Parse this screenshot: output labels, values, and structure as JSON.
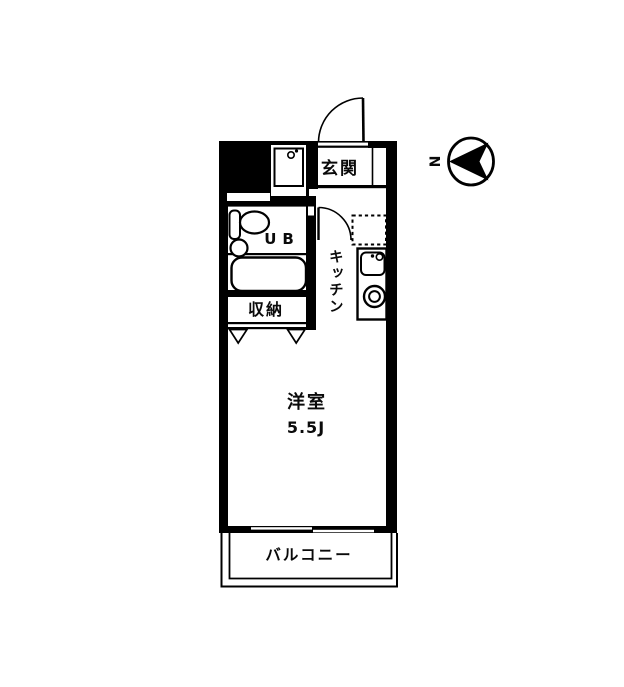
{
  "meta": {
    "type": "apartment-floor-plan",
    "layout": "1R studio"
  },
  "colors": {
    "ink": "#000000",
    "paper": "#ffffff"
  },
  "labels": {
    "entrance": "玄関",
    "unit_bath": "UB",
    "kitchen": "キッチン",
    "storage": "収納",
    "western_room": "洋室",
    "room_size": "5.5J",
    "balcony": "バルコニー",
    "north": "N"
  },
  "compass": {
    "label": "N",
    "arrow_direction": "left"
  }
}
